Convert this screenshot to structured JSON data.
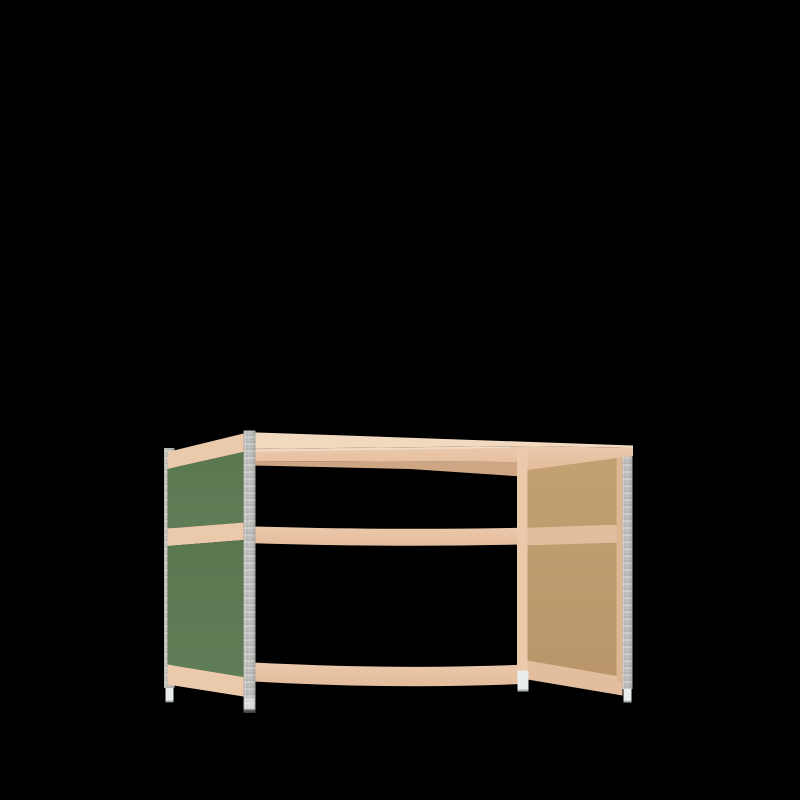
{
  "scene": {
    "type": "3d-product-render",
    "object": "boltless-shelving-workbench-frame",
    "view": "front-left three-quarter view",
    "description": "Open shelving workbench frame with galvanized steel corner posts, beech-toned wooden top, middle and bottom rails, a green painted side panel on the left (seen from outside), a raw MDF side panel on the right (seen from inside), and white leveling feet, rendered on a black background.",
    "background": "#000000"
  },
  "colors": {
    "background": "#000000",
    "wood_top": "#f0d9be",
    "wood_face": "#ebc9ab",
    "wood_face_deep": "#e3bc9c",
    "wood_shaded": "#e2bd9e",
    "wood_edge": "#dcb591",
    "wood_dark": "#cfa683",
    "green_top": "#5a7850",
    "green_bottom": "#5f7d56",
    "mdf_light": "#c2a071",
    "mdf_dark": "#b9966a",
    "metal_base": "#c7c7c5",
    "metal_stripe_dark": "#b0b0ae",
    "metal_stripe_mid": "#bdbdbb",
    "metal_stripe_light": "#dcdcda",
    "foot": "#eaeded",
    "foot_shadow": "#a9aeae",
    "post_base": "#5c5f5f",
    "post_base_dark": "#3e4141"
  },
  "parts": [
    {
      "id": "rear-left-post",
      "label": "Galvanized steel post (rear left)",
      "material": "galvanized steel"
    },
    {
      "id": "rear-right-post",
      "label": "Galvanized steel post (rear right)",
      "material": "galvanized steel"
    },
    {
      "id": "front-left-post",
      "label": "Galvanized steel post (front left)",
      "material": "galvanized steel"
    },
    {
      "id": "front-right-stile",
      "label": "Wooden corner stile (front right)",
      "material": "wood"
    },
    {
      "id": "top-shelf-assembly",
      "label": "Top shelf with front beam",
      "material": "wood"
    },
    {
      "id": "middle-front-beam",
      "label": "Middle front beam",
      "material": "wood"
    },
    {
      "id": "bottom-front-beam",
      "label": "Bottom front beam",
      "material": "wood"
    },
    {
      "id": "left-side-panel",
      "label": "Left side panel, green painted exterior with wooden rails",
      "material": "painted MDF"
    },
    {
      "id": "right-side-panel",
      "label": "Right side panel, raw MDF interior with wooden rails",
      "material": "MDF"
    },
    {
      "id": "leveling-feet",
      "label": "White leveling feet",
      "material": "plastic"
    }
  ]
}
